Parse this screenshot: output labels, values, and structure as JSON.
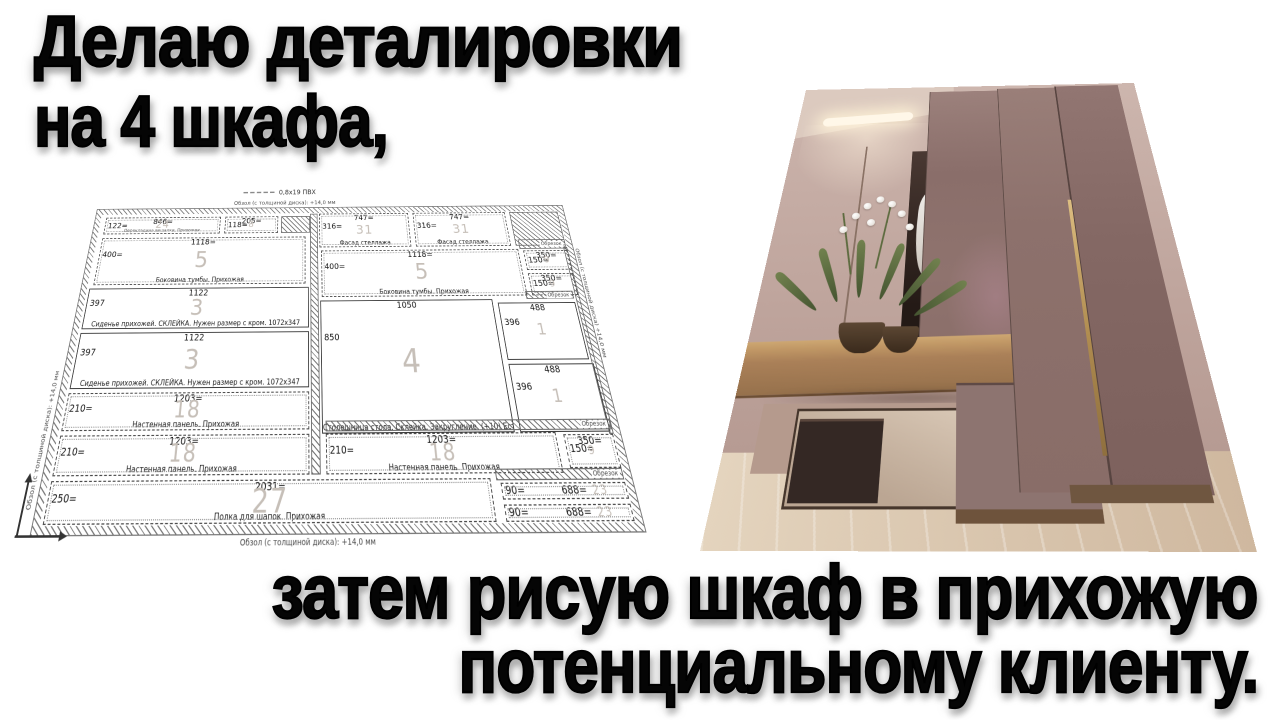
{
  "thumbnail": {
    "heading_top": [
      "Делаю деталировки",
      "на 4 шкафа,"
    ],
    "heading_bottom": [
      "затем рисую шкаф в прихожую",
      "потенциальному клиенту."
    ]
  },
  "diagram": {
    "legend_pvc": "0,8x19 ПВХ",
    "edge_note": "Обзол (с толщиной диска): +14,0 мм",
    "edge_note_right": "Обзол (с толщиной диска) +14,0 мм",
    "offcut_label": "Обрезок",
    "panels": [
      {
        "x": 14,
        "y": 11,
        "w": 152,
        "h": 22,
        "top": "846=",
        "left": "122=",
        "qty": "24",
        "name": "Перекладина вешалки. Прихожая",
        "style": "dashed",
        "tiny": true
      },
      {
        "x": 172,
        "y": 11,
        "w": 70,
        "h": 22,
        "top": "205=",
        "left": "118=",
        "qty": "8",
        "name": "",
        "style": "dashed"
      },
      {
        "x": 296,
        "y": 8,
        "w": 118,
        "h": 44,
        "top": "747=",
        "left": "316=",
        "qty": "31",
        "name": "Фасад стеллажа",
        "style": "dashed"
      },
      {
        "x": 420,
        "y": 8,
        "w": 122,
        "h": 44,
        "top": "747=",
        "left": "316=",
        "qty": "31",
        "name": "Фасад стеллажа",
        "style": "dashed"
      },
      {
        "x": 14,
        "y": 38,
        "w": 264,
        "h": 58,
        "top": "1118=",
        "left": "400=",
        "qty": "5",
        "name": "Боковина тумбы. Прихожая",
        "style": "dashed"
      },
      {
        "x": 298,
        "y": 56,
        "w": 252,
        "h": 56,
        "top": "1118=",
        "left": "400=",
        "qty": "5",
        "name": "Боковина тумбы. Прихожая",
        "style": "dashed"
      },
      {
        "x": 556,
        "y": 58,
        "w": 56,
        "h": 24,
        "top": "350=",
        "left": "150=",
        "qty": "9",
        "name": "",
        "style": "dashed"
      },
      {
        "x": 556,
        "y": 86,
        "w": 56,
        "h": 26,
        "top": "350=",
        "left": "150=",
        "qty": "9",
        "name": "",
        "style": "dashed"
      },
      {
        "x": 10,
        "y": 100,
        "w": 272,
        "h": 46,
        "top": "1122",
        "left": "397",
        "qty": "3",
        "name": "Сиденье прихожей. СКЛЕЙКА. Нужен размер с кром. 1072x347",
        "style": "solid"
      },
      {
        "x": 10,
        "y": 150,
        "w": 272,
        "h": 58,
        "top": "1122",
        "left": "397",
        "qty": "3",
        "name": "Сиденье прихожей. СКЛЕЙКА. Нужен размер с кром. 1072x347",
        "style": "solid"
      },
      {
        "x": 296,
        "y": 116,
        "w": 210,
        "h": 136,
        "top": "1050",
        "left": "850",
        "qty": "4",
        "name": "Столешница стола. Склейка. Закругление. (+10) Есть схема",
        "style": "solid"
      },
      {
        "x": 512,
        "y": 120,
        "w": 94,
        "h": 62,
        "top": "488",
        "left": "396",
        "qty": "1",
        "name": "",
        "style": "solid"
      },
      {
        "x": 512,
        "y": 186,
        "w": 98,
        "h": 66,
        "top": "488",
        "left": "396",
        "qty": "1",
        "name": "",
        "style": "solid"
      },
      {
        "x": 10,
        "y": 212,
        "w": 272,
        "h": 36,
        "top": "1203=",
        "left": "210=",
        "qty": "18",
        "name": "Настенная панель. Прихожая",
        "style": "dashed"
      },
      {
        "x": 10,
        "y": 252,
        "w": 272,
        "h": 36,
        "top": "1203=",
        "left": "210=",
        "qty": "18",
        "name": "Настенная панель. Прихожая",
        "style": "dashed"
      },
      {
        "x": 300,
        "y": 252,
        "w": 250,
        "h": 36,
        "top": "1203=",
        "left": "210=",
        "qty": "18",
        "name": "Настенная панель. Прихожая",
        "style": "dashed"
      },
      {
        "x": 558,
        "y": 254,
        "w": 54,
        "h": 30,
        "top": "350=",
        "left": "150=",
        "qty": "9",
        "name": "",
        "style": "dashed"
      },
      {
        "x": 10,
        "y": 292,
        "w": 462,
        "h": 36,
        "top": "2031=",
        "left": "250=",
        "qty": "27",
        "name": "Полка для шапок. Прихожая",
        "style": "dashed"
      },
      {
        "x": 482,
        "y": 296,
        "w": 130,
        "h": 14,
        "top": "688=",
        "left": "90=",
        "qty": "23",
        "name": "",
        "style": "dashed"
      },
      {
        "x": 482,
        "y": 314,
        "w": 130,
        "h": 14,
        "top": "688=",
        "left": "90=",
        "qty": "23",
        "name": "",
        "style": "dashed"
      }
    ],
    "hatches": [
      {
        "x": 246,
        "y": 11,
        "w": 38,
        "h": 22,
        "label": false
      },
      {
        "x": 284,
        "y": 8,
        "w": 10,
        "h": 280,
        "label": false
      },
      {
        "x": 548,
        "y": 8,
        "w": 64,
        "h": 44,
        "label": false
      },
      {
        "x": 552,
        "y": 44,
        "w": 60,
        "h": 12,
        "label": true
      },
      {
        "x": 608,
        "y": 54,
        "w": 5,
        "h": 200,
        "label": false
      },
      {
        "x": 548,
        "y": 107,
        "w": 58,
        "h": 9,
        "label": true
      },
      {
        "x": 300,
        "y": 240,
        "w": 312,
        "h": 10,
        "label": true
      },
      {
        "x": 478,
        "y": 284,
        "w": 134,
        "h": 10,
        "label": true
      }
    ]
  },
  "colors": {
    "heading": "#050505",
    "qty_number": "#c6bfb8",
    "diagram_line": "#444444",
    "wardrobe_door": "#8d7370",
    "console_wood": "#b0855c",
    "floor_wood": "#dcc9b2",
    "wall": "#c4aba3",
    "handle_brass": "#c9a86a"
  }
}
